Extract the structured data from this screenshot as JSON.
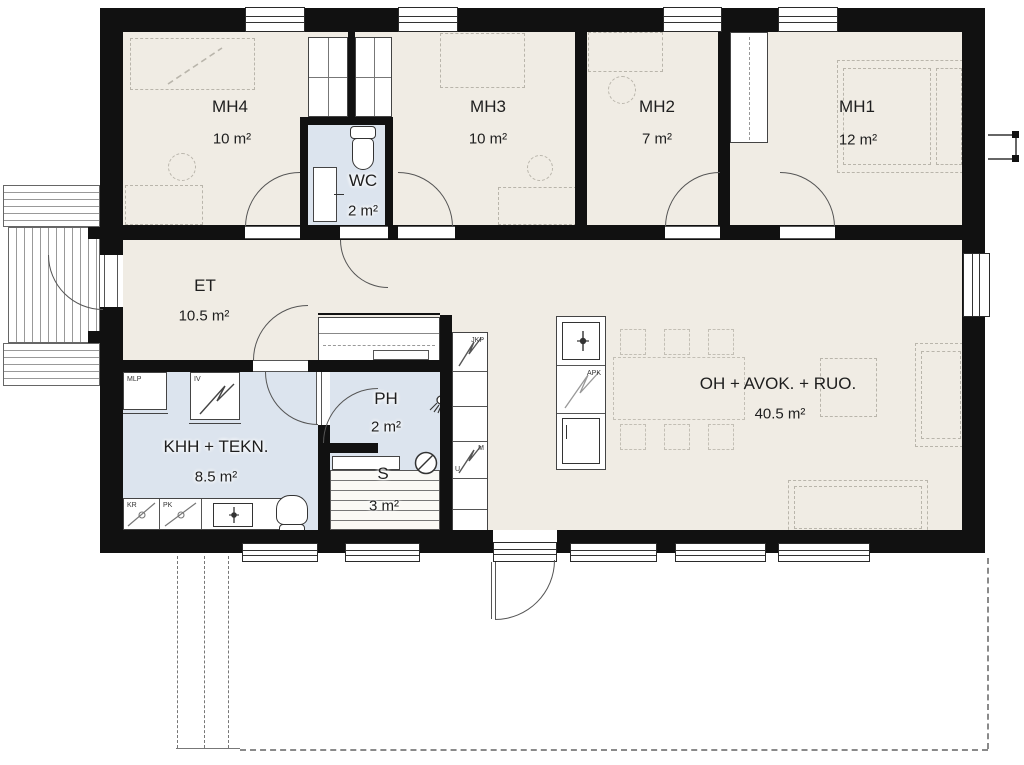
{
  "plan": {
    "rooms": [
      {
        "id": "mh4",
        "name": "MH4",
        "area": "10 m²"
      },
      {
        "id": "wc",
        "name": "WC",
        "area": "2 m²"
      },
      {
        "id": "mh3",
        "name": "MH3",
        "area": "10 m²"
      },
      {
        "id": "mh2",
        "name": "MH2",
        "area": "7 m²"
      },
      {
        "id": "mh1",
        "name": "MH1",
        "area": "12 m²"
      },
      {
        "id": "et",
        "name": "ET",
        "area": "10.5 m²"
      },
      {
        "id": "khh",
        "name": "KHH + TEKN.",
        "area": "8.5 m²"
      },
      {
        "id": "ph",
        "name": "PH",
        "area": "2 m²"
      },
      {
        "id": "s",
        "name": "S",
        "area": "3 m²"
      },
      {
        "id": "oh",
        "name": "OH + AVOK. + RUO.",
        "area": "40.5 m²"
      }
    ],
    "appliances": {
      "mlp": "MLP",
      "iv": "IV",
      "kr": "KR",
      "pk": "PK",
      "jkp": "JKP",
      "m": "M",
      "u": "U",
      "apk": "APK"
    },
    "colors": {
      "wall": "#111111",
      "floor": "#f0ece4",
      "wet_floor": "#dce4ee",
      "line": "#555555",
      "furniture_dash": "#b9b5ab"
    }
  }
}
